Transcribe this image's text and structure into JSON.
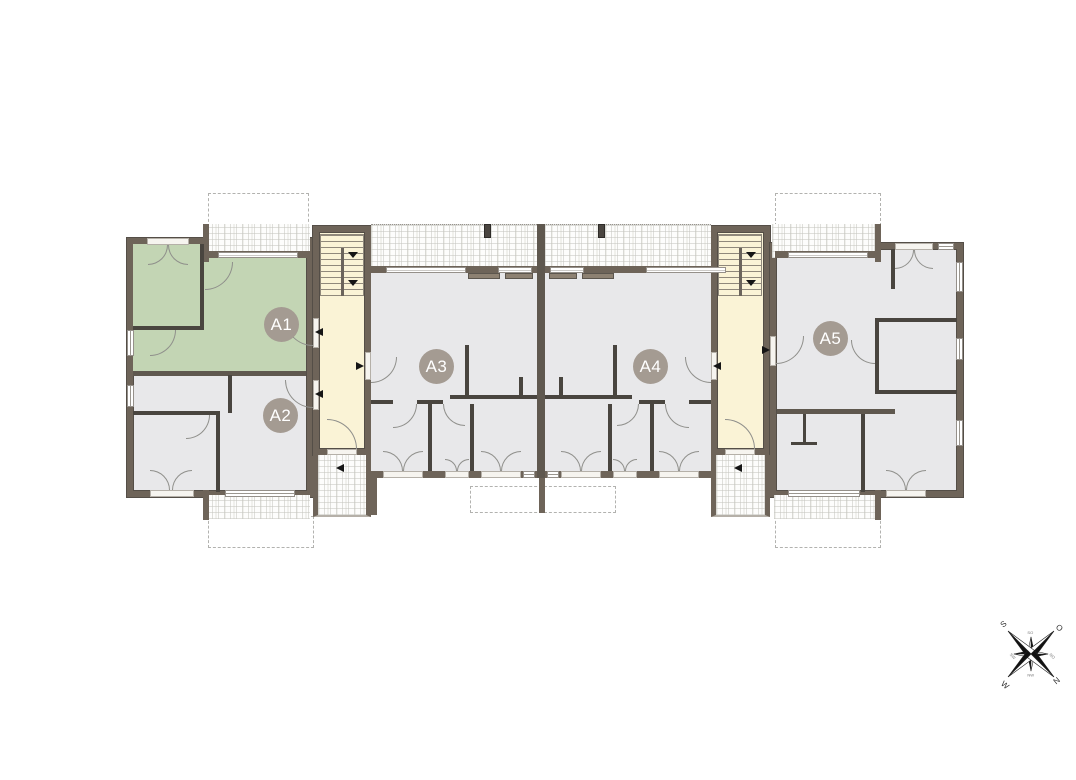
{
  "plan": {
    "apartments": [
      {
        "label": "A1",
        "highlighted": true,
        "fill": "#c3d5b4"
      },
      {
        "label": "A2",
        "highlighted": false,
        "fill": "#e8e8ea"
      },
      {
        "label": "A3",
        "highlighted": false,
        "fill": "#e8e8ea"
      },
      {
        "label": "A4",
        "highlighted": false,
        "fill": "#e8e8ea"
      },
      {
        "label": "A5",
        "highlighted": false,
        "fill": "#e8e8ea"
      }
    ],
    "compass": {
      "north": "N",
      "east": "O",
      "south": "S",
      "west": "W",
      "northeast": "NO",
      "southeast": "SO",
      "southwest": "SW",
      "northwest": "NW"
    },
    "colors": {
      "highlight_green": "#c3d5b4",
      "room_gray": "#e8e8ea",
      "stairwell_cream": "#faf3d6",
      "outer_wall": "#6e6459",
      "interior_wall": "#49453f",
      "label_circle": "#a49b92"
    }
  }
}
